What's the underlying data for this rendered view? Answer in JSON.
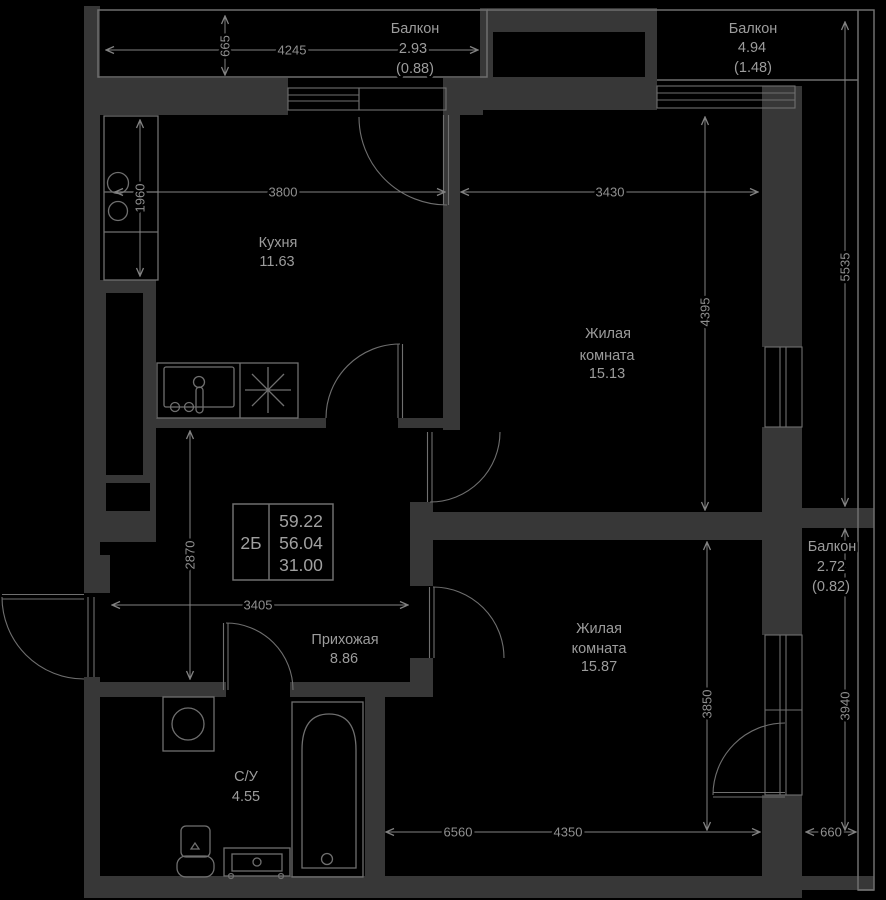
{
  "colors": {
    "background": "#000000",
    "walls": "#373737",
    "lines": "#6f6f6f",
    "dimension_lines": "#828282",
    "text": "#9c9c9c"
  },
  "unit": {
    "label": "2Б",
    "v1": "59.22",
    "v2": "56.04",
    "v3": "31.00"
  },
  "rooms": {
    "kitchen": {
      "name": "Кухня",
      "area": "11.63"
    },
    "living1": {
      "name1": "Жилая",
      "name2": "комната",
      "area": "15.13"
    },
    "living2": {
      "name1": "Жилая",
      "name2": "комната",
      "area": "15.87"
    },
    "hall": {
      "name": "Прихожая",
      "area": "8.86"
    },
    "bath": {
      "name": "С/У",
      "area": "4.55"
    }
  },
  "balconies": {
    "top_left": {
      "name": "Балкон",
      "area": "2.93",
      "reduced": "(0.88)"
    },
    "top_right": {
      "name": "Балкон",
      "area": "4.94",
      "reduced": "(1.48)"
    },
    "right": {
      "name": "Балкон",
      "area": "2.72",
      "reduced": "(0.82)"
    }
  },
  "dims": {
    "d4245": "4245",
    "d665": "665",
    "d3800": "3800",
    "d1960": "1960",
    "d3430": "3430",
    "d4395": "4395",
    "d5535": "5535",
    "d2870": "2870",
    "d3405": "3405",
    "d3850": "3850",
    "d3940": "3940",
    "d6560": "6560",
    "d4350": "4350",
    "d660": "660"
  }
}
